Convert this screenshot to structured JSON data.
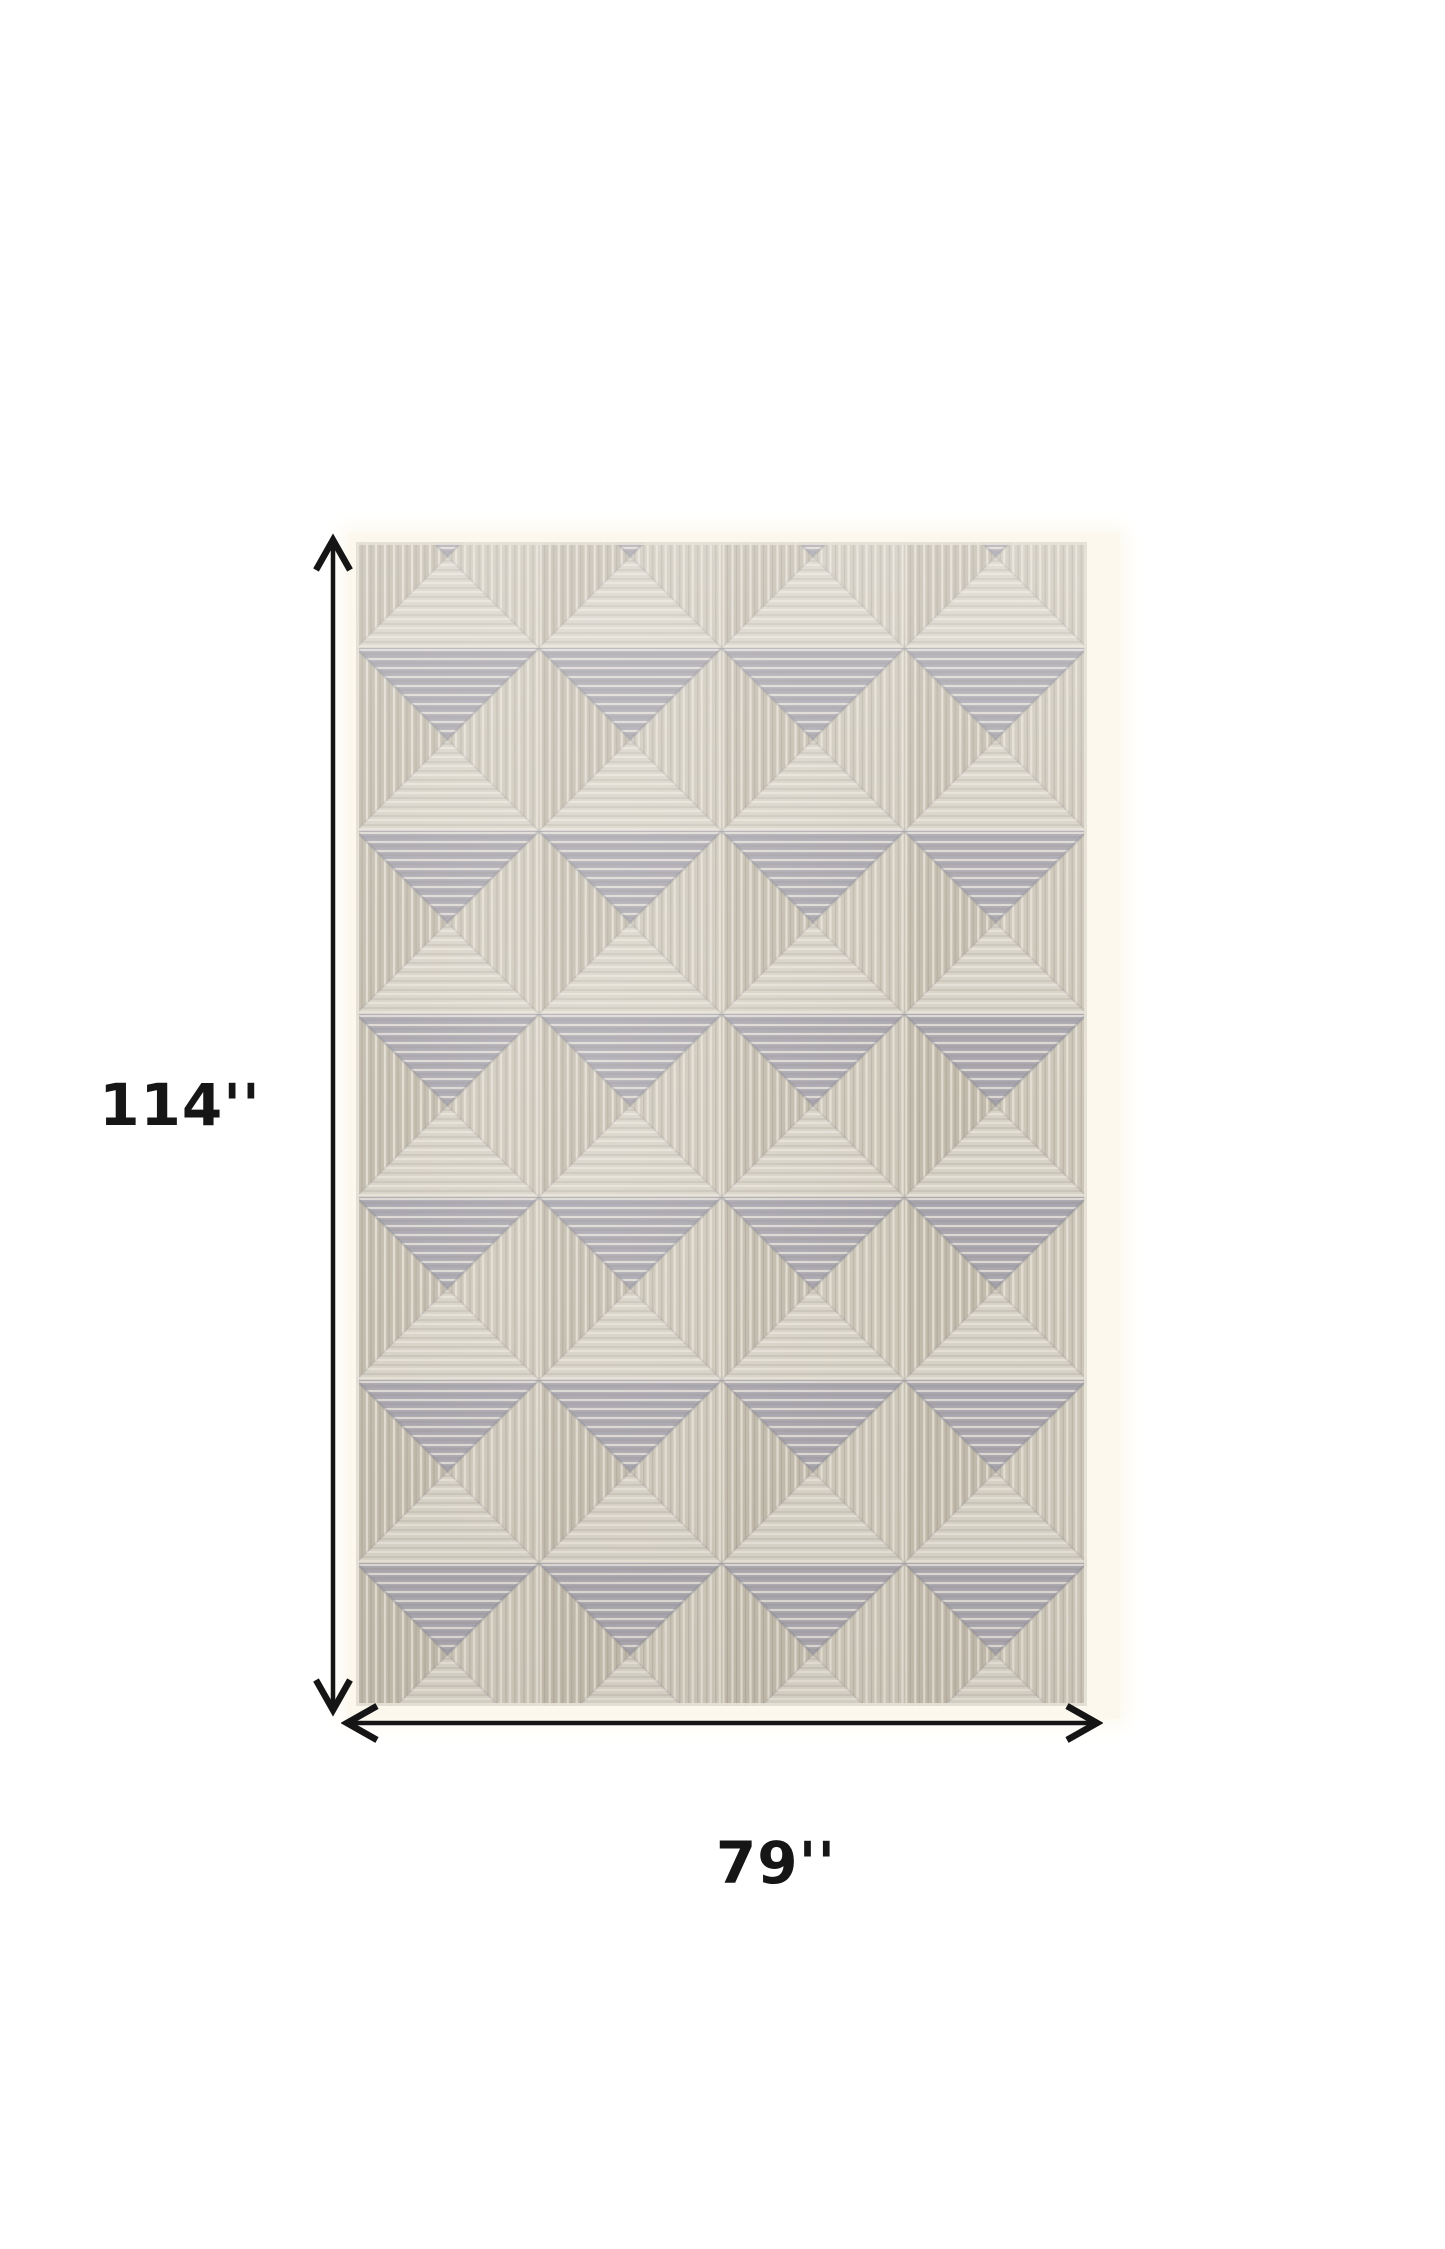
{
  "figure": {
    "type": "product-dimension-diagram",
    "background_color": "#ffffff"
  },
  "dimensions": {
    "height_label": "114''",
    "width_label": "79''"
  },
  "annotation": {
    "arrow_color": "#151515",
    "label_color": "#161616"
  },
  "rug": {
    "name": "gray-taupe-geometric-pyramid-pattern-rug",
    "grid_columns": 4,
    "tile_size_px": 183,
    "pattern_offset_y_px": -77,
    "colors": {
      "base": "#cfc9bb",
      "top_triangle": "#a8a5ae",
      "left_triangle": "#c2bbac",
      "right_triangle": "#cdc7b9",
      "bottom_triangle": "#d7d2c6",
      "light_line": "#e8e4da",
      "dark_line": "#8d887e",
      "diagonal_shadow": "#7e7d88",
      "edge": "#e6e2d7",
      "backdrop": "#fcf8ee"
    }
  }
}
